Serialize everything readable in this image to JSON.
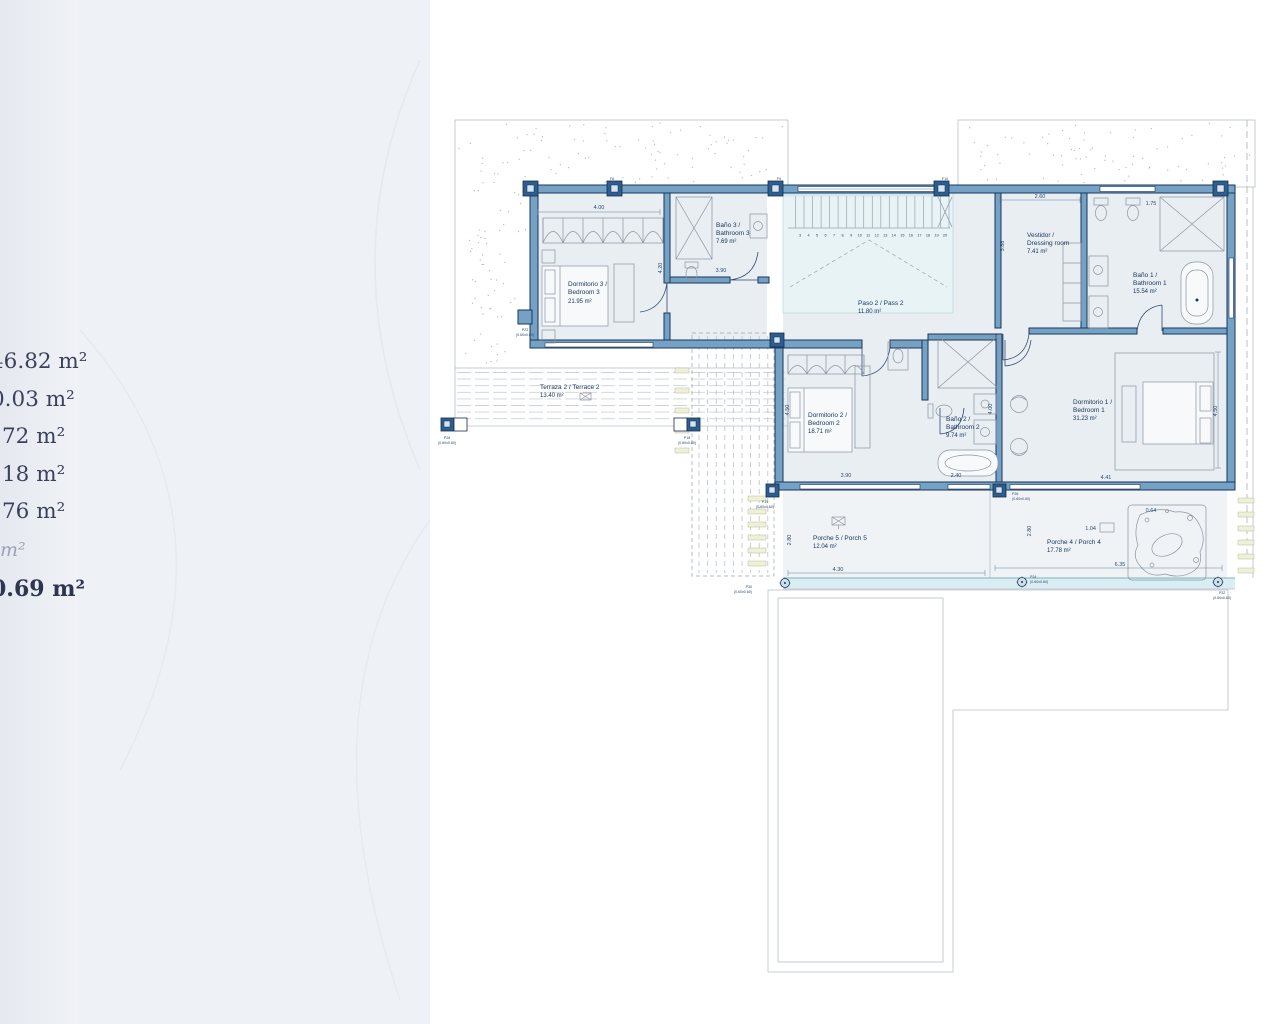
{
  "sidebar": {
    "values": [
      "46.82 m²",
      "0.03 m²",
      "72 m²",
      "18 m²",
      "76 m²",
      "m²",
      "0.69 m²"
    ]
  },
  "plan": {
    "rooms": {
      "bedroom3": {
        "l1": "Dormitorio 3 /",
        "l2": "Bedroom 3",
        "area": "21.95 m²"
      },
      "bath3": {
        "l1": "Baño 3 /",
        "l2": "Bathroom 3",
        "area": "7.69 m²"
      },
      "paso2": {
        "l1": "Paso 2 / Pass 2",
        "area": "11.80 m²"
      },
      "vestidor": {
        "l1": "Vestidor /",
        "l2": "Dressing room",
        "area": "7.41 m²"
      },
      "bath1": {
        "l1": "Baño 1 /",
        "l2": "Bathroom 1",
        "area": "15.54 m²"
      },
      "bedroom2": {
        "l1": "Dormitorio 2 /",
        "l2": "Bedroom 2",
        "area": "18.71 m²"
      },
      "bath2": {
        "l1": "Baño 2 /",
        "l2": "Bathroom 2",
        "area": "9.74 m²"
      },
      "bedroom1": {
        "l1": "Dormitorio 1 /",
        "l2": "Bedroom 1",
        "area": "31.23 m²"
      },
      "porch5": {
        "l1": "Porche 5 / Porch 5",
        "area": "12.04 m²"
      },
      "porch4": {
        "l1": "Porche 4 / Porch 4",
        "area": "17.78 m²"
      },
      "terrace2": {
        "l1": "Terraza 2 / Terrace 2",
        "area": "13.40 m²"
      }
    },
    "dims": {
      "d400": "4.00",
      "d420": "4.20",
      "d390": "3.90",
      "d260": "2.60",
      "d388": "3.88",
      "d175": "1.75",
      "d450r": "4.50",
      "d441": "4.41",
      "d450l": "4.50",
      "d390b": "3.90",
      "d240": "2.40",
      "d400v": "4.00",
      "d430": "4.30",
      "d280p5": "2.80",
      "d280p4": "2.80",
      "d635": "6.35",
      "d104": "1.04",
      "d064": "0.64"
    },
    "stairs": {
      "numbers": [
        "3",
        "4",
        "5",
        "6",
        "7",
        "8",
        "9",
        "10",
        "11",
        "12",
        "13",
        "14",
        "15",
        "16",
        "17",
        "18",
        "19",
        "20"
      ]
    },
    "marks": {
      "f8": "F8",
      "f9": "F9",
      "f10": "F10",
      "p22": "P22",
      "p28": "P28",
      "p18": "P18",
      "p19": "P19",
      "p26": "P26",
      "p30": "P30",
      "p24": "P24",
      "p32": "P32",
      "dim060": "(0.60x0.60)"
    }
  },
  "colors": {
    "wall": "#74a1c4",
    "wall_dark": "#17365c",
    "room": "#e9eef3",
    "accent_cyan": "#cfe9f0",
    "text_navy": "#16335a",
    "terrain_mark": "#94a0a7"
  }
}
